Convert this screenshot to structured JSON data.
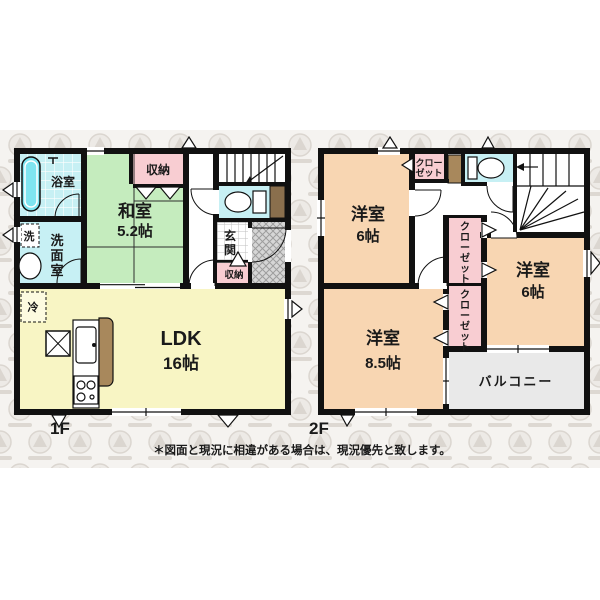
{
  "meta": {
    "title_1f": "1F",
    "title_2f": "2F"
  },
  "colors": {
    "wall": "#111111",
    "wet_room": "#c7f0f4",
    "bathtub": "#7fe4f0",
    "tatami": "#c5ecbe",
    "closet_pink": "#f8cdd2",
    "western_peach": "#f8d6b2",
    "ldk_yellow": "#f8f5c4",
    "balcony_gray": "#e9e9e9",
    "counter_brown": "#a8885c",
    "watermark_band": "#f5f3f0"
  },
  "floor1": {
    "label": "1F",
    "bath": "浴室",
    "washroom_vertical": "洗面室",
    "washer": "洗",
    "tatami_name": "和室",
    "tatami_size": "5.2帖",
    "storage_top": "収納",
    "genkan_vertical": "玄関",
    "genkan_storage": "収納",
    "ldk_name": "LDK",
    "ldk_size": "16帖",
    "fridge": "冷"
  },
  "floor2": {
    "label": "2F",
    "room_nw_name": "洋室",
    "room_nw_size": "6帖",
    "room_e_name": "洋室",
    "room_e_size": "6帖",
    "room_s_name": "洋室",
    "room_s_size": "8.5帖",
    "closet_top_line1": "クロー",
    "closet_top_line2": "ゼット",
    "closet_mid_vertical": "クローゼット",
    "closet_low_vertical": "クローゼット",
    "balcony": "バルコニー"
  },
  "footer": {
    "disclaimer": "＊図面と現況に相違がある場合は、現況優先と致します。"
  }
}
